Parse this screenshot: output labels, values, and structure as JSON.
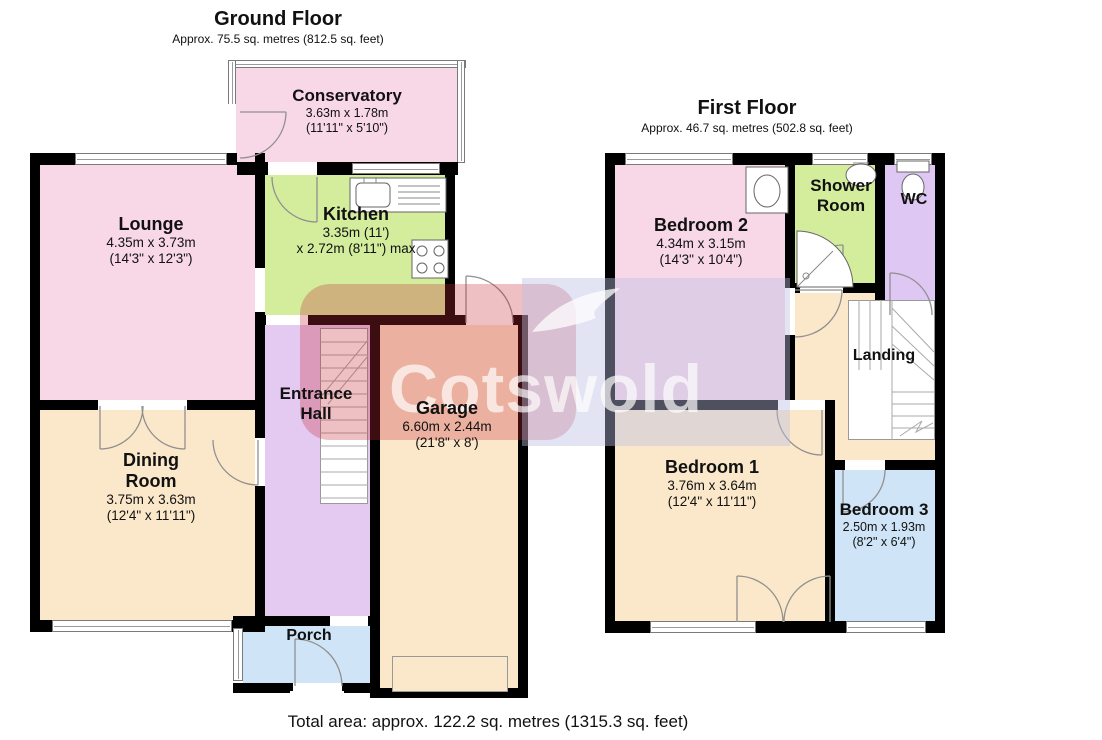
{
  "ground_floor": {
    "title": "Ground Floor",
    "subtitle": "Approx. 75.5 sq. metres (812.5 sq. feet)",
    "rooms": {
      "conservatory": {
        "name": "Conservatory",
        "dim_metric": "3.63m x 1.78m",
        "dim_imperial": "(11'11\" x 5'10\")",
        "color": "#f8d7e7"
      },
      "lounge": {
        "name": "Lounge",
        "dim_metric": "4.35m x 3.73m",
        "dim_imperial": "(14'3\" x 12'3\")",
        "color": "#f8d7e7"
      },
      "kitchen": {
        "name": "Kitchen",
        "dim_metric": "3.35m (11')",
        "dim_imperial": "x 2.72m (8'11\") max",
        "color": "#d3ed9d"
      },
      "entrance_hall": {
        "name": "Entrance Hall",
        "name_line1": "Entrance",
        "name_line2": "Hall",
        "color": "#e4c9f1"
      },
      "garage": {
        "name": "Garage",
        "dim_metric": "6.60m x 2.44m",
        "dim_imperial": "(21'8\" x 8')",
        "color": "#fbe8ca"
      },
      "dining_room": {
        "name": "Dining Room",
        "name_line1": "Dining",
        "name_line2": "Room",
        "dim_metric": "3.75m x 3.63m",
        "dim_imperial": "(12'4\" x 11'11\")",
        "color": "#fbe8ca"
      },
      "porch": {
        "name": "Porch",
        "color": "#cfe5f7"
      }
    }
  },
  "first_floor": {
    "title": "First Floor",
    "subtitle": "Approx. 46.7 sq. metres (502.8 sq. feet)",
    "rooms": {
      "bedroom2": {
        "name": "Bedroom 2",
        "dim_metric": "4.34m x 3.15m",
        "dim_imperial": "(14'3\" x 10'4\")",
        "color": "#f8d7e7"
      },
      "shower_room": {
        "name": "Shower Room",
        "name_line1": "Shower",
        "name_line2": "Room",
        "color": "#d3ed9d"
      },
      "wc": {
        "name": "WC",
        "color": "#dfc7f3"
      },
      "landing": {
        "name": "Landing",
        "color": "#fbe8ca"
      },
      "bedroom1": {
        "name": "Bedroom 1",
        "dim_metric": "3.76m x 3.64m",
        "dim_imperial": "(12'4\" x 11'11\")",
        "color": "#fbe8ca"
      },
      "bedroom3": {
        "name": "Bedroom 3",
        "dim_metric": "2.50m x 1.93m",
        "dim_imperial": "(8'2\" x 6'4\")",
        "color": "#cfe5f7"
      }
    }
  },
  "footer": {
    "total_area": "Total area: approx. 122.2 sq. metres (1315.3 sq. feet)"
  },
  "watermark": {
    "text": "Cotswold",
    "red": "#c6303a",
    "lavender": "#babfe2"
  }
}
